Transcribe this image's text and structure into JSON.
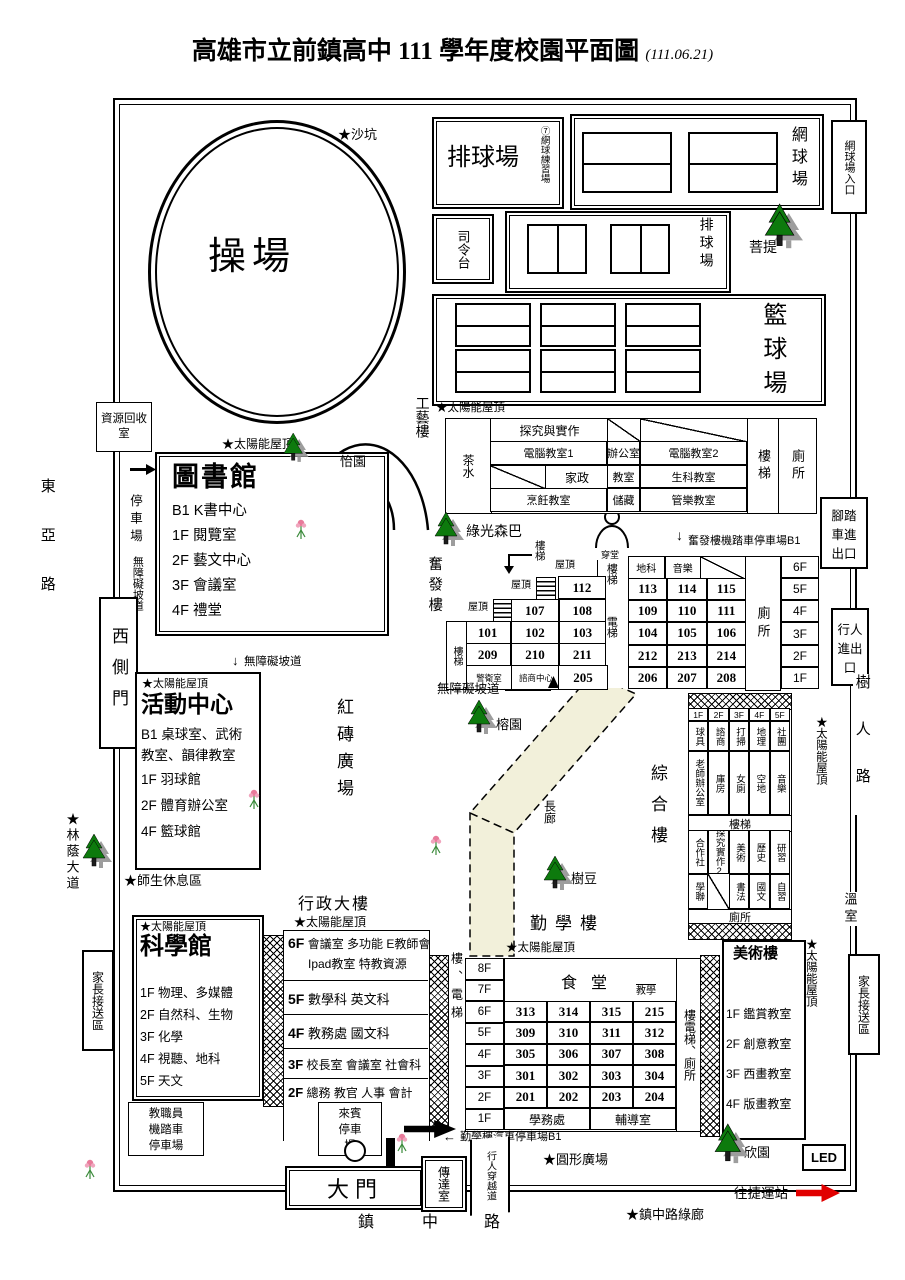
{
  "title": {
    "text": "高雄市立前鎮高中 111 學年度校園平面圖",
    "date": "(111.06.21)"
  },
  "arrows": {
    "down": "↓",
    "up": "↑",
    "left": "←"
  },
  "roads": {
    "west": "東亞路",
    "east": "樹人路",
    "south": [
      "鎮",
      "中",
      "路"
    ],
    "crossing": "行人穿越道",
    "to_mrt": "往捷運站",
    "green_corridor": "★鎮中路綠廊"
  },
  "common": {
    "solar": "★太陽能屋頂",
    "stairs": "樓梯",
    "toilet": "廁所",
    "roof": "屋頂",
    "ramp": "無障礙坡道"
  },
  "field": {
    "name": "操場",
    "sandpit": "★沙坑"
  },
  "courts": {
    "volleyball1": "排球場",
    "volleyball1_sub": "⑦網球練習場",
    "tennis": "網球場",
    "podium": "司令台",
    "volleyball2": "排球場",
    "basketball": "籃球場"
  },
  "gardens": {
    "yi": "怡園",
    "green_light": "綠光森巴",
    "bodhi": "菩提",
    "rong": "榕園",
    "tree_bean": "樹豆",
    "xin": "欣園",
    "lin_avenue": "★林蔭大道",
    "red_brick": "紅磚廣場",
    "corridor": "長廊",
    "rest_area": "★師生休息區",
    "round_plaza": "★圓形廣場"
  },
  "gongyi": {
    "name": "工藝樓",
    "side": "茶水",
    "r1": "探究與實作",
    "r2": [
      "電腦教室1",
      "辦公室",
      "電腦教室2"
    ],
    "r3_1": "家政",
    "r3": [
      "教室",
      "生科教室"
    ],
    "r4": [
      "烹飪教室",
      "儲藏",
      "管樂教室"
    ]
  },
  "library": {
    "name": "圖書館",
    "floors": [
      "B1 K書中心",
      "1F 閱覽室",
      "2F 藝文中心",
      "3F 會議室",
      "4F 禮堂"
    ]
  },
  "activity": {
    "name": "活動中心",
    "floors": [
      "B1 桌球室、武術教室、韻律教室",
      "1F 羽球館",
      "2F 體育辦公室",
      "4F 籃球館"
    ]
  },
  "science": {
    "name": "科學館",
    "floors": [
      "1F 物理、多媒體",
      "2F 自然科、生物",
      "3F 化學",
      "4F 視聽、地科",
      "5F 天文"
    ]
  },
  "admin": {
    "name": "行政大樓",
    "f6": "6F",
    "f6a": "會議室 多功能 E教師會",
    "f6b": "Ipad教室 特教資源",
    "f5": "5F",
    "f5t": "數學科 英文科",
    "f4": "4F",
    "f4t": "教務處 國文科",
    "f3": "3F",
    "f3t": "校長室 會議室 社會科",
    "f2": "2F",
    "f2t": "總務 教官 人事 會計",
    "entrance": "玄關"
  },
  "fenfa": {
    "name": "奮發樓",
    "tower": "穿堂",
    "lift": "電梯",
    "left": {
      "r1": [
        "112"
      ],
      "r2": [
        "107",
        "108"
      ],
      "r3": [
        "101",
        "102",
        "103"
      ],
      "r4": [
        "209",
        "210",
        "211"
      ]
    },
    "guard": "警衛室",
    "counsel": "諮商中心",
    "r205": "205",
    "head": [
      "地科",
      "音樂"
    ],
    "rooms": [
      [
        "113",
        "114",
        "115"
      ],
      [
        "109",
        "110",
        "111"
      ],
      [
        "104",
        "105",
        "106"
      ],
      [
        "212",
        "213",
        "214"
      ],
      [
        "206",
        "207",
        "208"
      ]
    ],
    "floors": [
      "6F",
      "5F",
      "4F",
      "3F",
      "2F",
      "1F"
    ],
    "parking": "奮發樓機踏車停車場B1"
  },
  "zonghe": {
    "name": "綜合樓",
    "floors": [
      "1F",
      "2F",
      "3F",
      "4F",
      "5F"
    ],
    "r1": [
      "球具",
      "諮商",
      "打掃",
      "地理",
      "社團"
    ],
    "r2": [
      "老師辦公室",
      "庫房",
      "女廁",
      "空地",
      "音樂"
    ],
    "r3": [
      "合作社",
      "探究實作2",
      "美術",
      "歷史",
      "研習"
    ],
    "r4": [
      "學聯",
      "",
      "書法",
      "國文",
      "自習"
    ],
    "greenhouse": "溫室"
  },
  "qinxue": {
    "name": "勤學樓",
    "left_col": "樓、電梯",
    "floors": [
      "8F",
      "7F",
      "6F",
      "5F",
      "4F",
      "3F",
      "2F",
      "1F"
    ],
    "hall": "食堂",
    "hall_sub": "教學",
    "rooms": [
      [
        "313",
        "314",
        "315",
        "215"
      ],
      [
        "309",
        "310",
        "311",
        "312"
      ],
      [
        "305",
        "306",
        "307",
        "308"
      ],
      [
        "301",
        "302",
        "303",
        "304"
      ],
      [
        "201",
        "202",
        "203",
        "204"
      ]
    ],
    "f1": [
      "學務處",
      "輔導室"
    ],
    "right_col": "樓電梯、廁所",
    "parking": "勤學樓汽車停車場B1"
  },
  "art": {
    "name": "美術樓",
    "floors": [
      "1F 鑑賞教室",
      "2F 創意教室",
      "3F 西畫教室",
      "4F 版畫教室"
    ]
  },
  "gates": {
    "west": "西側門",
    "main": "大門",
    "reception": "傳達室",
    "bike": [
      "腳踏",
      "車進",
      "出口"
    ],
    "ped": [
      "行人",
      "進出",
      "口"
    ],
    "tennis_entry": "網球場入口"
  },
  "parking": {
    "lot": "停車場",
    "recycle": "資源回收室",
    "staff": [
      "教職員",
      "機踏車",
      "停車場"
    ],
    "guest": [
      "來賓",
      "停車",
      "場"
    ],
    "family": "家長接送區"
  },
  "misc": {
    "led": "LED"
  }
}
